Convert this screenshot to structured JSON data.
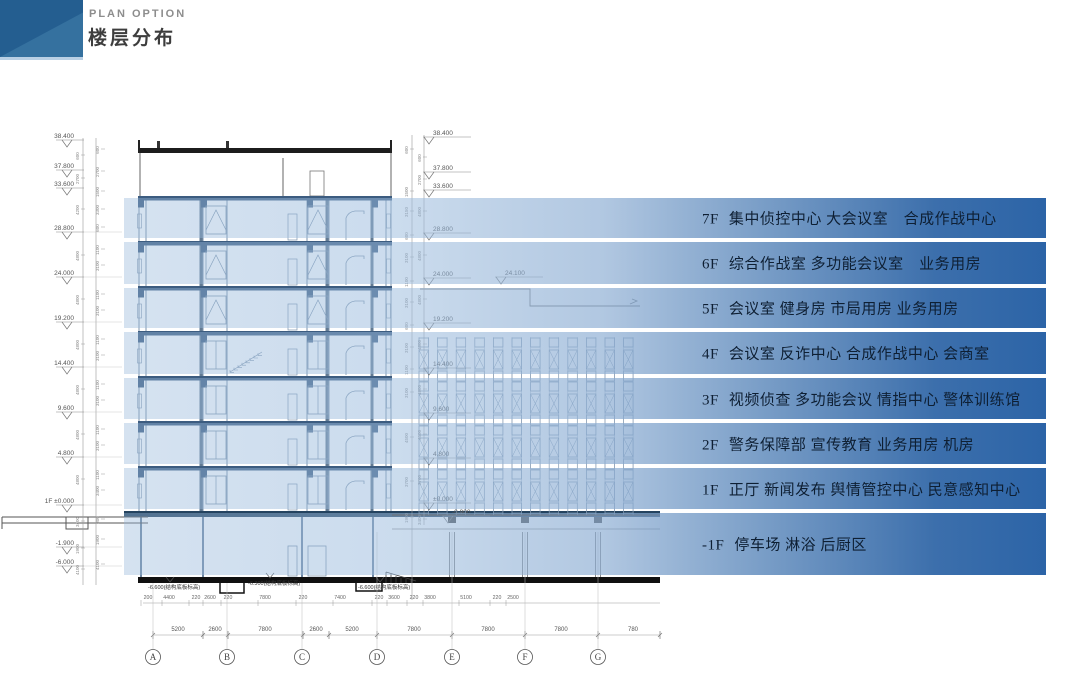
{
  "header": {
    "eyebrow": "PLAN OPTION",
    "title": "楼层分布"
  },
  "floors": [
    {
      "level": "7F",
      "rooms": "集中侦控中心 大会议室　合成作战中心"
    },
    {
      "level": "6F",
      "rooms": "综合作战室 多功能会议室　业务用房"
    },
    {
      "level": "5F",
      "rooms": "会议室 健身房 市局用房 业务用房"
    },
    {
      "level": "4F",
      "rooms": "会议室 反诈中心 合成作战中心 会商室"
    },
    {
      "level": "3F",
      "rooms": "视频侦查 多功能会议 情指中心 警体训练馆"
    },
    {
      "level": "2F",
      "rooms": "警务保障部 宣传教育 业务用房 机房"
    },
    {
      "level": "1F",
      "rooms": "正厅 新闻发布 舆情管控中心 民意感知中心"
    },
    {
      "level": "-1F",
      "rooms": "停车场 淋浴 后厨区"
    }
  ],
  "drawing": {
    "left_markers": [
      {
        "y": 140,
        "t": "38.400"
      },
      {
        "y": 170,
        "t": "37.800"
      },
      {
        "y": 188,
        "t": "33.600"
      },
      {
        "y": 232,
        "t": "28.800"
      },
      {
        "y": 277,
        "t": "24.000"
      },
      {
        "y": 322,
        "t": "19.200"
      },
      {
        "y": 367,
        "t": "14.400"
      },
      {
        "y": 412,
        "t": "9.600"
      },
      {
        "y": 457,
        "t": "4.800"
      },
      {
        "y": 505,
        "t": "±0.000",
        "pre": "1F"
      },
      {
        "y": 547,
        "t": "-1.900"
      },
      {
        "y": 566,
        "t": "-6.000"
      }
    ],
    "mid_markers": [
      {
        "y": 137,
        "t": "38.400"
      },
      {
        "y": 172,
        "t": "37.800"
      },
      {
        "y": 190,
        "t": "33.600"
      },
      {
        "y": 233,
        "t": "28.800"
      },
      {
        "y": 278,
        "t": "24.000"
      },
      {
        "y": 277,
        "t": "24.100",
        "x": 505
      },
      {
        "y": 323,
        "t": "19.200"
      },
      {
        "y": 368,
        "t": "14.400"
      },
      {
        "y": 413,
        "t": "9.600"
      },
      {
        "y": 458,
        "t": "4.800"
      },
      {
        "y": 503,
        "t": "±0.000"
      },
      {
        "y": 516,
        "t": "-0.900",
        "x": 452
      }
    ],
    "left_dims_outer": [
      {
        "y": 156,
        "v": "600"
      },
      {
        "y": 179,
        "v": "2700"
      },
      {
        "y": 210,
        "v": "4200"
      },
      {
        "y": 256,
        "v": "4800"
      },
      {
        "y": 300,
        "v": "4800"
      },
      {
        "y": 345,
        "v": "4800"
      },
      {
        "y": 390,
        "v": "4800"
      },
      {
        "y": 435,
        "v": "4800"
      },
      {
        "y": 480,
        "v": "4800"
      },
      {
        "y": 522,
        "v": "3400"
      },
      {
        "y": 549,
        "v": "1900"
      },
      {
        "y": 570,
        "v": "4100"
      }
    ],
    "left_dims_inner": [
      {
        "y": 150,
        "v": "600"
      },
      {
        "y": 172,
        "v": "2700"
      },
      {
        "y": 192,
        "v": "1500"
      },
      {
        "y": 210,
        "v": "3300"
      },
      {
        "y": 228,
        "v": "600"
      },
      {
        "y": 250,
        "v": "1100"
      },
      {
        "y": 266,
        "v": "3100"
      },
      {
        "y": 295,
        "v": "1100"
      },
      {
        "y": 311,
        "v": "3100"
      },
      {
        "y": 340,
        "v": "1100"
      },
      {
        "y": 356,
        "v": "3100"
      },
      {
        "y": 385,
        "v": "1100"
      },
      {
        "y": 401,
        "v": "3100"
      },
      {
        "y": 430,
        "v": "1100"
      },
      {
        "y": 446,
        "v": "3100"
      },
      {
        "y": 475,
        "v": "1100"
      },
      {
        "y": 491,
        "v": "3400"
      },
      {
        "y": 520,
        "v": "300"
      },
      {
        "y": 540,
        "v": "1900"
      },
      {
        "y": 565,
        "v": "4100"
      }
    ],
    "mid_dims_outer": [
      {
        "y": 158,
        "v": "600"
      },
      {
        "y": 180,
        "v": "2700"
      },
      {
        "y": 212,
        "v": "4800"
      },
      {
        "y": 256,
        "v": "4800"
      },
      {
        "y": 300,
        "v": "4800"
      },
      {
        "y": 345,
        "v": "4800"
      },
      {
        "y": 390,
        "v": "4800"
      },
      {
        "y": 435,
        "v": "4500"
      },
      {
        "y": 480,
        "v": "3700"
      },
      {
        "y": 520,
        "v": "3400"
      }
    ],
    "mid_dims_inner": [
      {
        "y": 150,
        "v": "600"
      },
      {
        "y": 192,
        "v": "1500"
      },
      {
        "y": 212,
        "v": "3150"
      },
      {
        "y": 236,
        "v": "600"
      },
      {
        "y": 258,
        "v": "3100"
      },
      {
        "y": 282,
        "v": "1100"
      },
      {
        "y": 303,
        "v": "3100"
      },
      {
        "y": 326,
        "v": "600"
      },
      {
        "y": 348,
        "v": "3100"
      },
      {
        "y": 370,
        "v": "1100"
      },
      {
        "y": 393,
        "v": "3100"
      },
      {
        "y": 438,
        "v": "4500"
      },
      {
        "y": 482,
        "v": "3700"
      },
      {
        "y": 518,
        "v": "1900"
      }
    ],
    "notes": [
      {
        "x": 148,
        "y": 589,
        "t": "-6.600(结构底板标高)"
      },
      {
        "x": 248,
        "y": 585,
        "t": "-6.300(结构底板标高)"
      },
      {
        "x": 358,
        "y": 589,
        "t": "-6.600(结构底板标高)"
      }
    ],
    "dim_row1": [
      {
        "x": 148,
        "v": "200"
      },
      {
        "x": 169,
        "v": "4400"
      },
      {
        "x": 196,
        "v": "220"
      },
      {
        "x": 210,
        "v": "2600"
      },
      {
        "x": 228,
        "v": "220"
      },
      {
        "x": 265,
        "v": "7800"
      },
      {
        "x": 303,
        "v": "220"
      },
      {
        "x": 340,
        "v": "7400"
      },
      {
        "x": 379,
        "v": "220"
      },
      {
        "x": 394,
        "v": "3600"
      },
      {
        "x": 414,
        "v": "220"
      },
      {
        "x": 430,
        "v": "3800"
      },
      {
        "x": 466,
        "v": "5100"
      },
      {
        "x": 497,
        "v": "220"
      },
      {
        "x": 513,
        "v": "2500"
      }
    ],
    "dim_row2": [
      {
        "x": 178,
        "v": "5200"
      },
      {
        "x": 215,
        "v": "2600"
      },
      {
        "x": 265,
        "v": "7800"
      },
      {
        "x": 316,
        "v": "2600"
      },
      {
        "x": 352,
        "v": "5200"
      },
      {
        "x": 414,
        "v": "7800"
      },
      {
        "x": 488,
        "v": "7800"
      },
      {
        "x": 561,
        "v": "7800"
      },
      {
        "x": 633,
        "v": "780"
      }
    ],
    "row2_ticks": [
      153,
      203,
      228,
      303,
      329,
      377,
      452,
      525,
      598,
      660
    ],
    "grid_bubbles": [
      {
        "x": 153,
        "t": "A"
      },
      {
        "x": 227,
        "t": "B"
      },
      {
        "x": 302,
        "t": "C"
      },
      {
        "x": 377,
        "t": "D"
      },
      {
        "x": 452,
        "t": "E"
      },
      {
        "x": 525,
        "t": "F"
      },
      {
        "x": 598,
        "t": "G"
      }
    ]
  }
}
